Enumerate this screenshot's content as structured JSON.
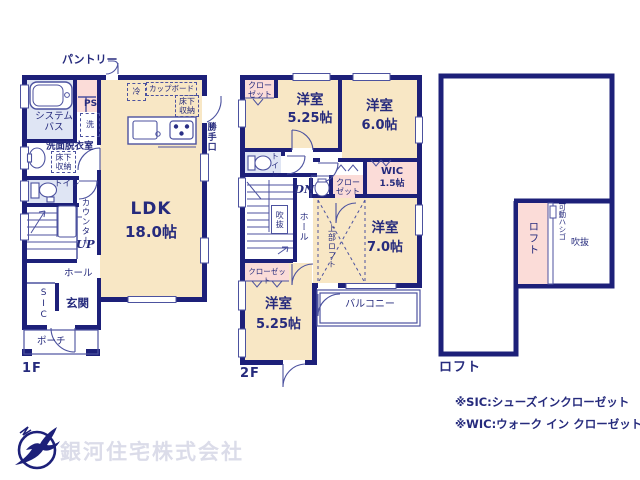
{
  "floor1": {
    "label": "1F",
    "rooms": {
      "pantry": "パントリー",
      "bath": "システムバス",
      "ps": "PS",
      "laundry": "洗",
      "washroom": "洗面脱衣室",
      "underfloor_wash": "床下収納",
      "toilet": "トイレ",
      "counter": "カウンター",
      "up": "UP",
      "hall": "ホール",
      "sic": "SIC",
      "entrance": "玄関",
      "porch": "ポーチ",
      "fridge": "冷",
      "cupboard": "カップボード",
      "underfloor_kitchen": "床下収納",
      "back_door": "勝手口",
      "ldk": "LDK",
      "ldk_size": "18.0帖"
    }
  },
  "floor2": {
    "label": "2F",
    "rooms": {
      "closet_top": "クローゼット",
      "room_a": "洋室",
      "room_a_size": "5.25帖",
      "room_b": "洋室",
      "room_b_size": "6.0帖",
      "toilet": "トイレ",
      "dn": "DN",
      "void": "吹抜",
      "hall": "ホール",
      "closet_mid": "クローゼット",
      "wic": "WIC",
      "wic_size": "1.5帖",
      "loft_above": "上部ロフト",
      "room_c": "洋室",
      "room_c_size": "7.0帖",
      "closet_bottom": "クローゼット",
      "room_d": "洋室",
      "room_d_size": "5.25帖",
      "balcony": "バルコニー"
    }
  },
  "loft": {
    "label": "ロフト",
    "rooms": {
      "loft": "ロフト",
      "ladder": "可動ハシゴ",
      "void": "吹抜"
    }
  },
  "notes": {
    "sic_note": "※SIC:シューズインクローゼット",
    "wic_note": "※WIC:ウォーク イン クローゼット"
  },
  "company": {
    "name": "銀河住宅株式会社"
  }
}
